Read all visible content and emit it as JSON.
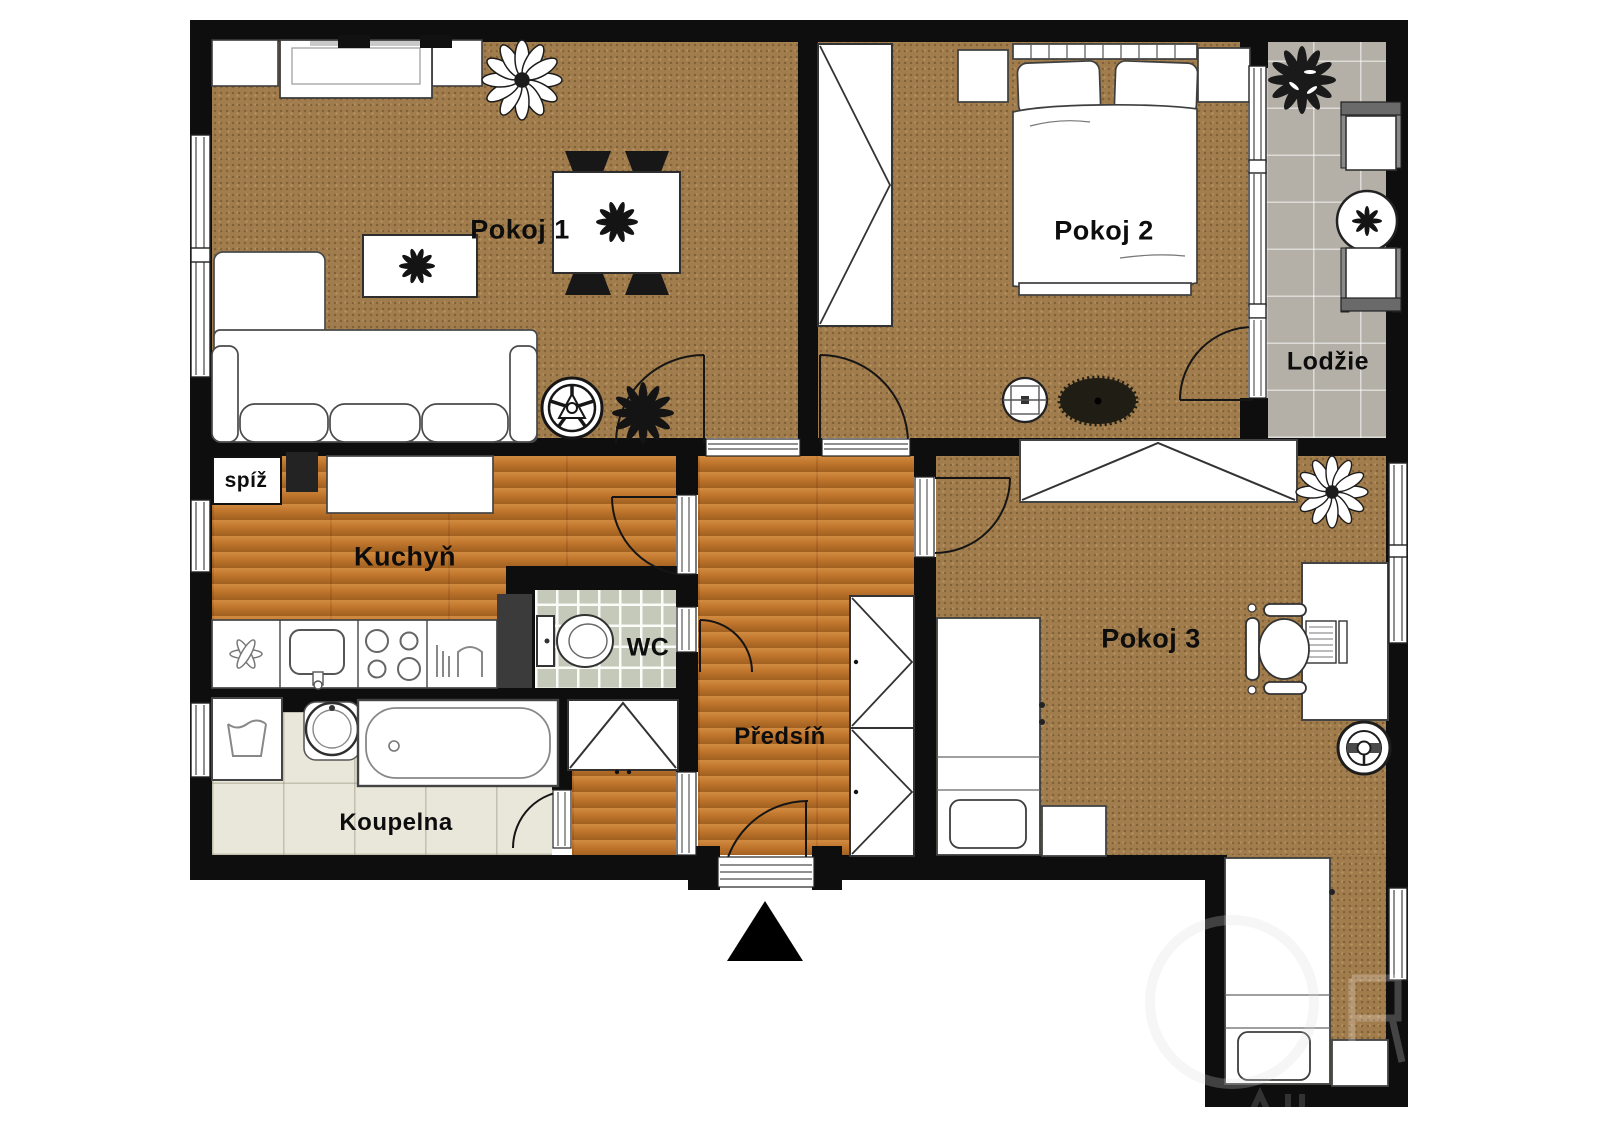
{
  "meta": {
    "type": "floor-plan",
    "language": "cs",
    "entrance_marker": "black-triangle-arrow"
  },
  "rooms": [
    {
      "id": "pokoj-1",
      "label": "Pokoj 1",
      "floor": "carpet"
    },
    {
      "id": "pokoj-2",
      "label": "Pokoj 2",
      "floor": "carpet"
    },
    {
      "id": "lodzie",
      "label": "Lodžie",
      "floor": "gray-tile"
    },
    {
      "id": "kuchyn",
      "label": "Kuchyň",
      "floor": "wood"
    },
    {
      "id": "spiz",
      "label": "spíž",
      "floor": "white"
    },
    {
      "id": "wc",
      "label": "WC",
      "floor": "green-tile"
    },
    {
      "id": "predsin",
      "label": "Předsíň",
      "floor": "wood"
    },
    {
      "id": "koupelna",
      "label": "Koupelna",
      "floor": "beige-tile"
    },
    {
      "id": "pokoj-3",
      "label": "Pokoj 3",
      "floor": "carpet"
    }
  ],
  "palette": {
    "wall": "#0e0e0e",
    "carpet": "#a17c4c",
    "wood": "#c0762c",
    "gray_tile": "#b4b0a7",
    "green_tile": "#c5c9ba",
    "beige_tile": "#e9e6da",
    "furniture_fill": "#ffffff",
    "furniture_outline": "#3e3e3e"
  },
  "icons": {
    "furniture": [
      "sofa",
      "coffee-table",
      "tv-sideboard",
      "cabinet",
      "dining-table",
      "dining-chair",
      "house-plant",
      "wagon-wheel",
      "double-bed",
      "pillow",
      "nightstand",
      "wardrobe",
      "ceiling-lamp",
      "rug",
      "balcony-chair",
      "balcony-table",
      "kitchen-counter",
      "kitchen-sink",
      "stove",
      "extractor-fan",
      "dishwasher",
      "pantry-shelf",
      "toilet",
      "washing-machine",
      "bathroom-sink",
      "bathtub",
      "hall-wardrobe",
      "single-bed",
      "desk",
      "laptop",
      "office-chair",
      "door-arc",
      "window",
      "threshold",
      "entrance-arrow"
    ]
  }
}
